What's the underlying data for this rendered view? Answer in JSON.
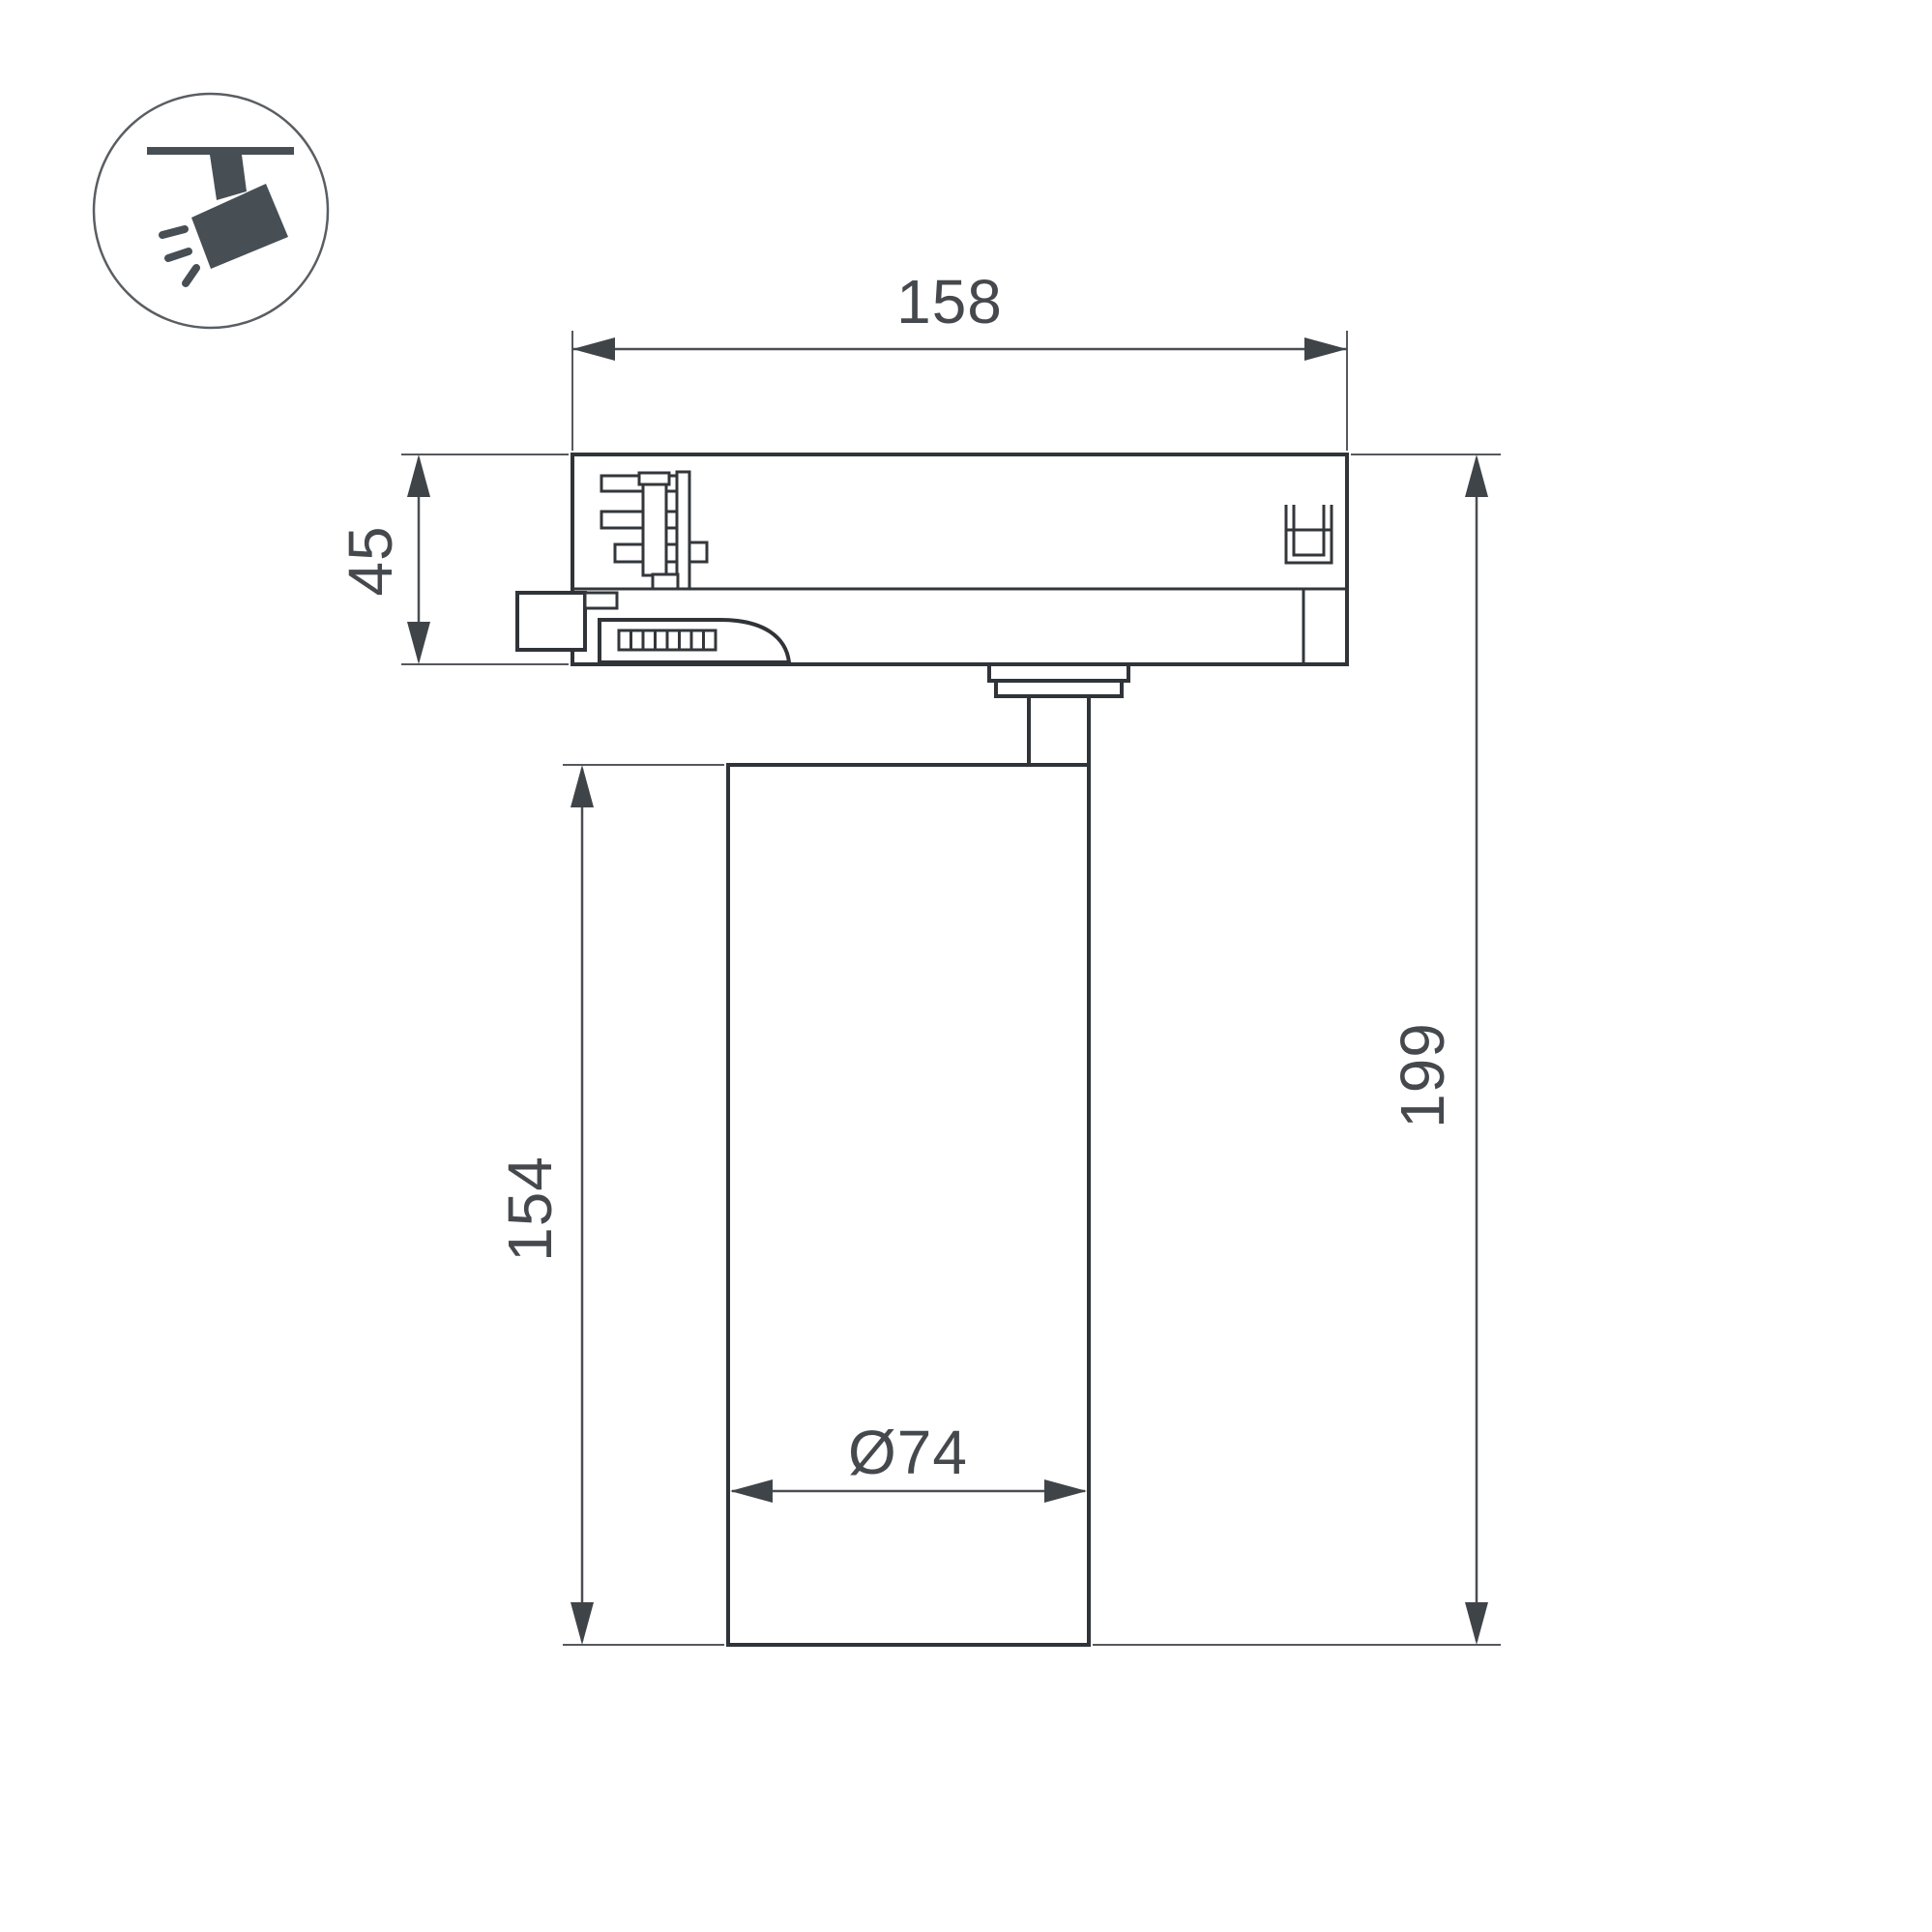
{
  "page": {
    "background": "#ffffff",
    "kind": "technical-dimension-drawing"
  },
  "icon": {
    "name": "track-spotlight-icon"
  },
  "labels": {
    "track_width": "158",
    "adapter_height": "45",
    "body_height": "154",
    "total_height": "199",
    "body_diameter": "Ø74"
  },
  "colors": {
    "object_line": "#303438",
    "dimension_line": "#4a4e52",
    "arrow": "#3f4449",
    "text": "#45494d",
    "icon": "#474e54"
  }
}
